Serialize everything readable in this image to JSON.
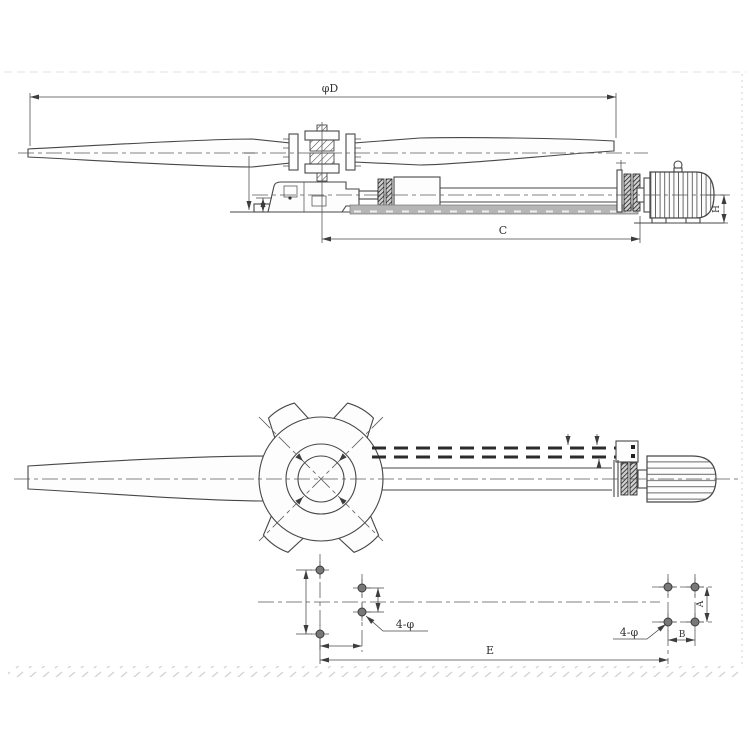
{
  "labels": {
    "fan_diameter": "φD",
    "length_c": "C",
    "motor_height": "H",
    "foundation_span_e": "E",
    "hole_pitch_a": "A",
    "hole_pitch_b": "B",
    "holes_left": "4-φ",
    "holes_right": "4-φ"
  },
  "colors": {
    "line": "#474747",
    "centerline": "#5a5a5a",
    "text": "#333333",
    "dark": "#1f1f1f",
    "beam": "#b5b5b5",
    "frame": "#dcdcdc",
    "background": "#ffffff"
  }
}
